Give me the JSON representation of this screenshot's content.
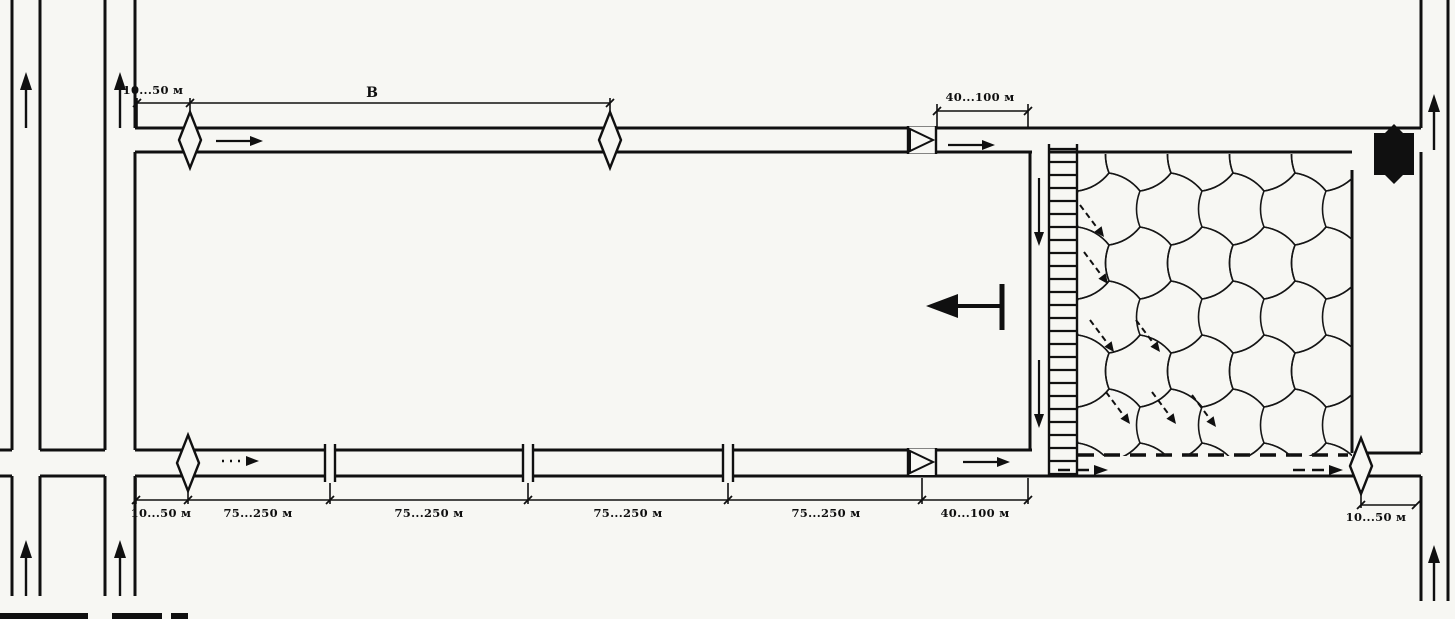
{
  "diagram": {
    "kind": "mine-ventilation-scheme-of-extraction-panel",
    "colors": {
      "ink": "#101010",
      "paper": "#f7f7f3"
    },
    "labels": {
      "top_entry_offset": "10...50 м",
      "panel_length_symbol": "В",
      "top_regulator_offset": "40...100 м",
      "bottom_offsets": [
        "10...50 м",
        "75...250 м",
        "75...250 м",
        "75...250 м",
        "75...250 м",
        "40...100 м"
      ],
      "tail_entry_offset": "10...50 м"
    },
    "legend_icons": {
      "diamond": "air-measuring-station-icon",
      "triangle_in_box": "ventilation-door-icon",
      "double_bars": "stopping-icon",
      "black_square": "permanent-stopping-icon",
      "ladder_strip": "powered-support-icon",
      "tessellation": "caved-goaf-pattern",
      "dashed_diagonal_arrows": "air-leakage-arrows",
      "tbar_arrow": "face-advance-direction-arrow"
    }
  }
}
